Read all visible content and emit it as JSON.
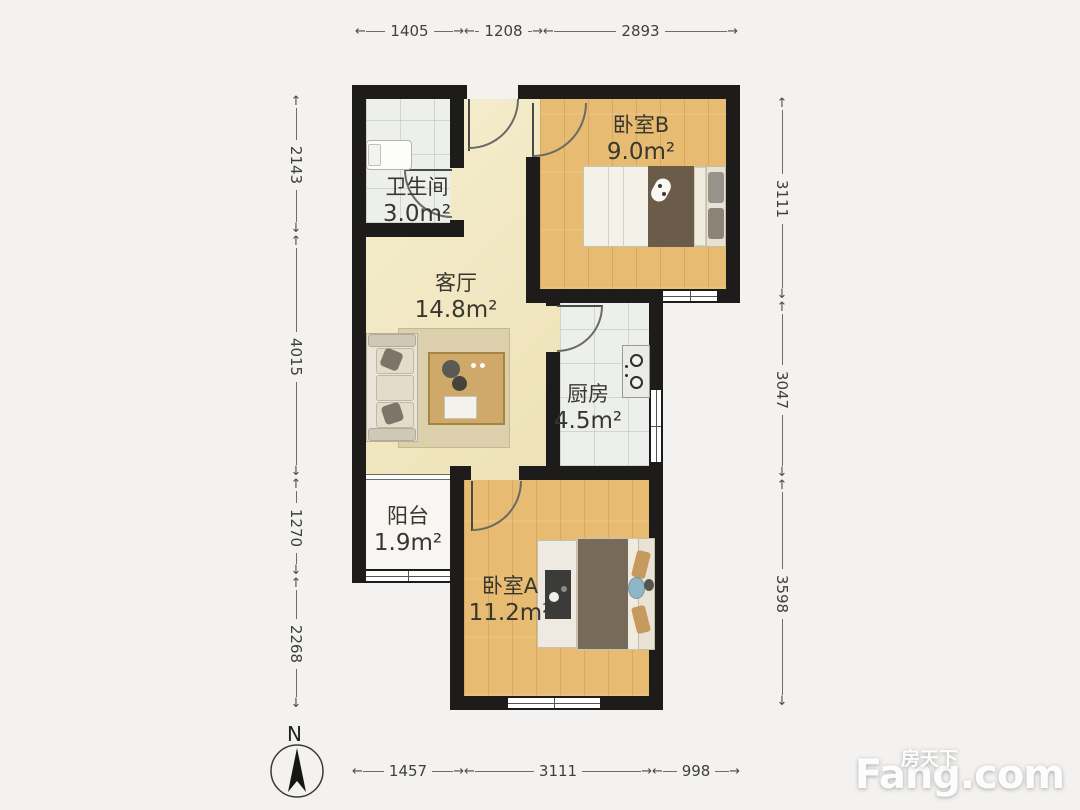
{
  "rooms": {
    "bedroom_b": {
      "name": "卧室B",
      "area": "9.0m²"
    },
    "bathroom": {
      "name": "卫生间",
      "area": "3.0m²"
    },
    "living_room": {
      "name": "客厅",
      "area": "14.8m²"
    },
    "kitchen": {
      "name": "厨房",
      "area": "4.5m²"
    },
    "balcony": {
      "name": "阳台",
      "area": "1.9m²"
    },
    "bedroom_a": {
      "name": "卧室A",
      "area": "11.2m²"
    }
  },
  "dimensions_mm": {
    "top": [
      "1405",
      "1208",
      "2893"
    ],
    "left": [
      "2143",
      "4015",
      "1270",
      "2268"
    ],
    "right": [
      "3111",
      "3047",
      "3598"
    ],
    "bottom": [
      "1457",
      "3111",
      "998"
    ]
  },
  "compass": {
    "north_label": "N"
  },
  "watermark": {
    "site_cn": "房天下",
    "site_en": "Fang.com"
  },
  "colors": {
    "wall": "#1d1c1a",
    "bedroom_floor": "#e8bb72",
    "living_floor": "#f2e8bf",
    "tile_floor": "#edefec",
    "balcony_floor": "#f7f6f2"
  }
}
